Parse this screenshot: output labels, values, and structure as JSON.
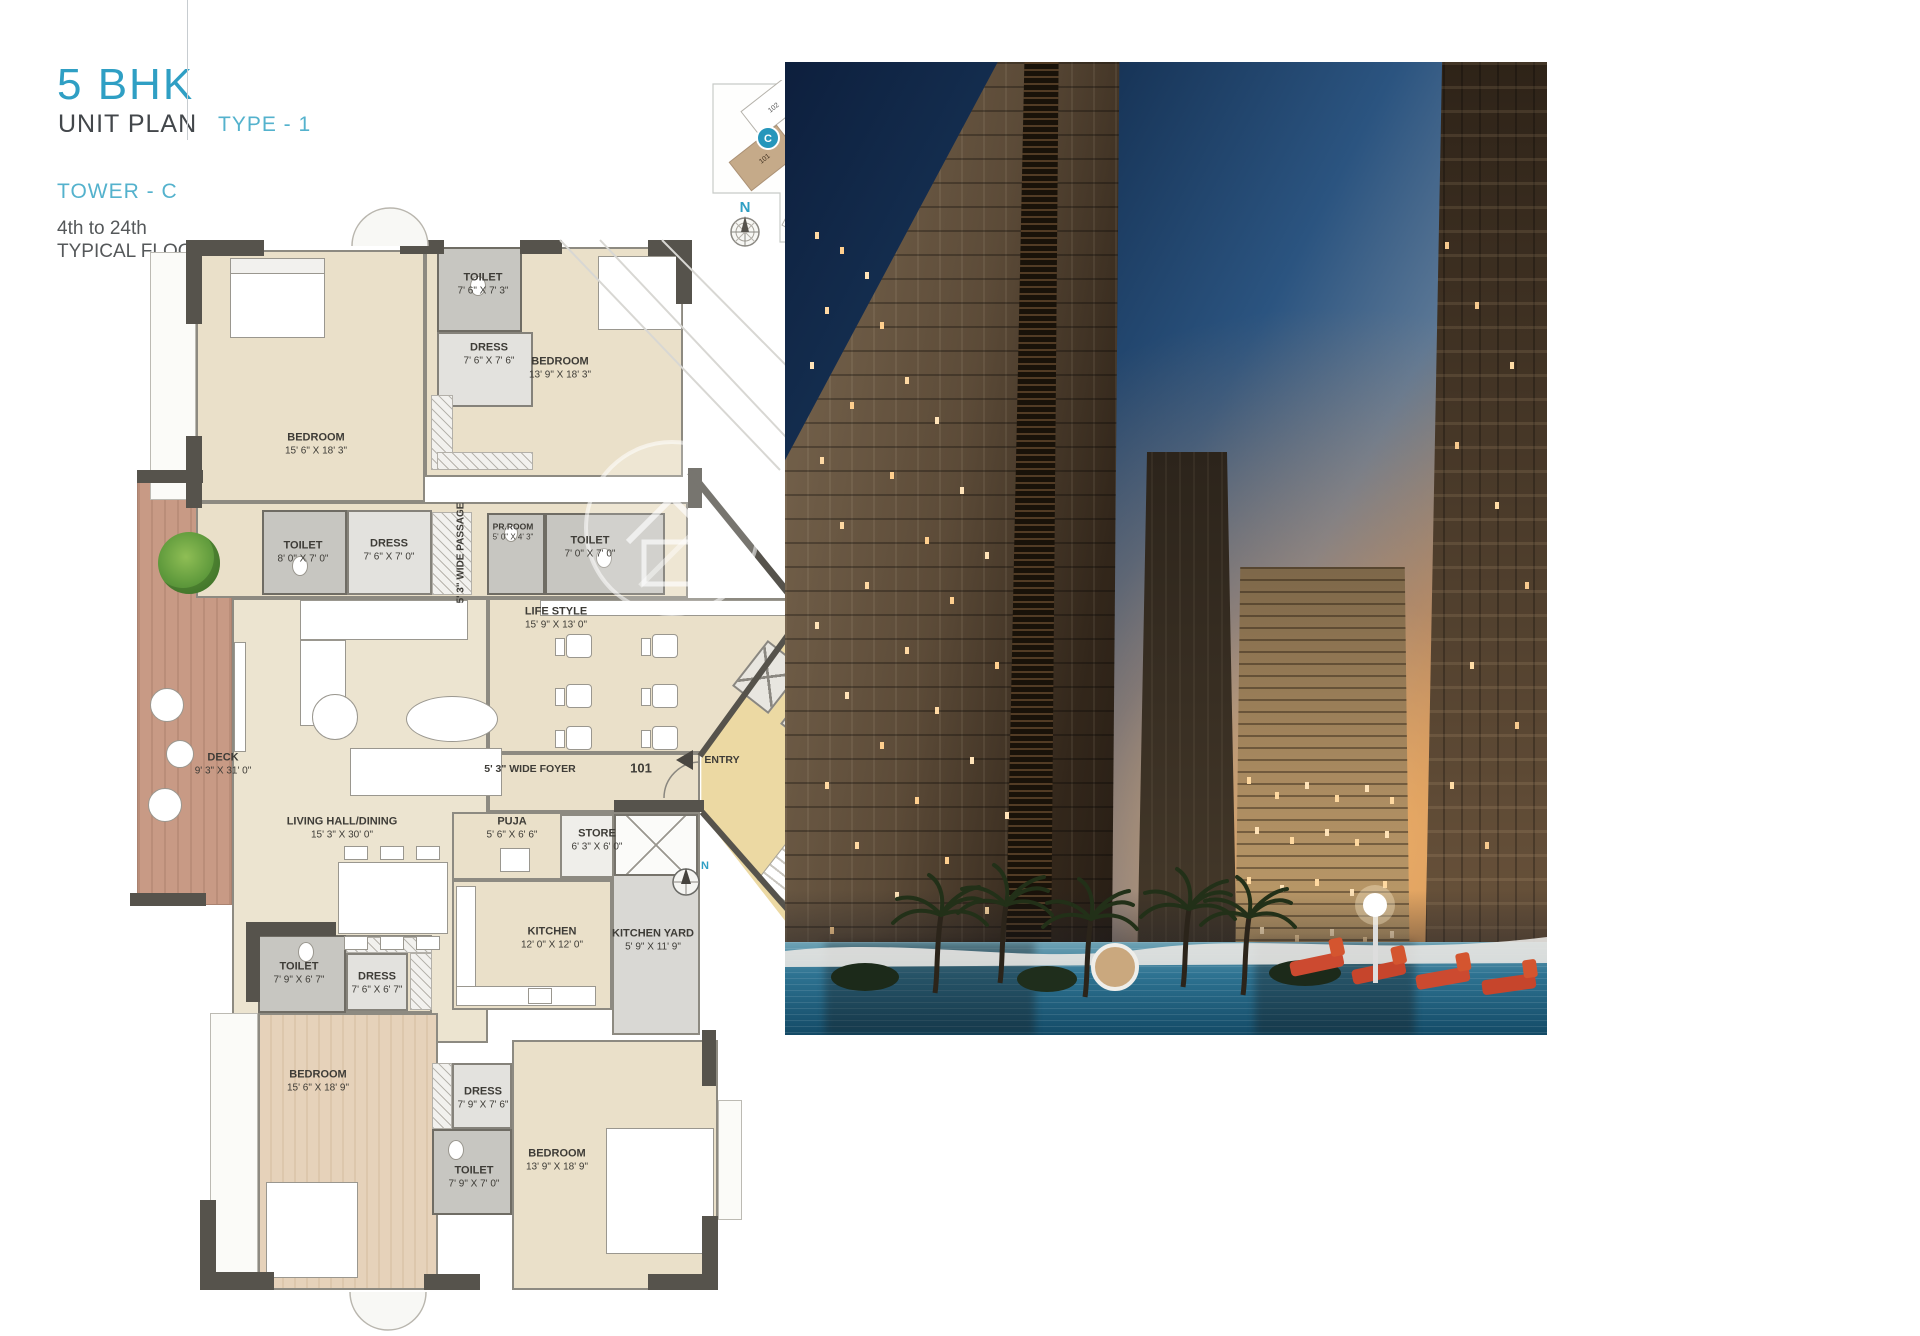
{
  "header": {
    "title": "5 BHK",
    "subtitle": "UNIT PLAN",
    "type": "TYPE - 1",
    "tower": "TOWER - C",
    "floor_line1": "4th to 24th",
    "floor_line2": "TYPICAL FLOOR"
  },
  "keyplan": {
    "badge_c": "C",
    "badge_b": "B",
    "badge_a": "A",
    "c_units": [
      "102",
      "101"
    ],
    "b_units": [
      "102",
      "101"
    ],
    "a_units": [
      "101",
      "103",
      "102"
    ],
    "compass_n": "N"
  },
  "plan": {
    "compass_n": "N",
    "unit_number": "101",
    "entry_label": "ENTRY",
    "foyer_label": "5' 3\" WIDE FOYER",
    "passage_label": "5' 3\" WIDE PASSAGE",
    "rooms": {
      "bedroom_tl": {
        "name": "BEDROOM",
        "dims": "15' 6\" X 18' 3\""
      },
      "toilet_top": {
        "name": "TOILET",
        "dims": "7' 6\" X 7' 3\""
      },
      "dress_top": {
        "name": "DRESS",
        "dims": "7' 6\" X 7' 6\""
      },
      "bedroom_tr": {
        "name": "BEDROOM",
        "dims": "13' 9\" X 18' 3\""
      },
      "toilet_ml": {
        "name": "TOILET",
        "dims": "8' 0\" X 7' 0\""
      },
      "dress_ml": {
        "name": "DRESS",
        "dims": "7' 6\" X 7' 0\""
      },
      "prroom": {
        "name": "PR.ROOM",
        "dims": "5' 0\" X 4' 3\""
      },
      "toilet_mr": {
        "name": "TOILET",
        "dims": "7' 0\" X 7' 0\""
      },
      "lifestyle": {
        "name": "LIFE STYLE",
        "dims": "15' 9\" X 13' 0\""
      },
      "deck": {
        "name": "DECK",
        "dims": "9' 3\" X 31' 0\""
      },
      "living": {
        "name": "LIVING HALL/DINING",
        "dims": "15' 3\" X 30' 0\""
      },
      "puja": {
        "name": "PUJA",
        "dims": "5' 6\" X 6' 6\""
      },
      "store": {
        "name": "STORE",
        "dims": "6' 3\" X 6' 0\""
      },
      "kitchen": {
        "name": "KITCHEN",
        "dims": "12' 0\" X 12' 0\""
      },
      "kitchen_yard": {
        "name": "KITCHEN YARD",
        "dims": "5' 9\" X 11' 9\""
      },
      "toilet_bl": {
        "name": "TOILET",
        "dims": "7' 9\" X 6' 7\""
      },
      "dress_bl": {
        "name": "DRESS",
        "dims": "7' 6\" X 6' 7\""
      },
      "bedroom_bl": {
        "name": "BEDROOM",
        "dims": "15' 6\" X 18' 9\""
      },
      "dress_bm": {
        "name": "DRESS",
        "dims": "7' 9\" X 7' 6\""
      },
      "toilet_bm": {
        "name": "TOILET",
        "dims": "7' 9\" X 7' 0\""
      },
      "bedroom_br": {
        "name": "BEDROOM",
        "dims": "13' 9\" X 18' 9\""
      }
    }
  },
  "colors": {
    "accent_teal": "#2f9fc4",
    "wall_dark": "#56534c",
    "floor_beige": "#eae0c9",
    "toilet_gray": "#c7c6c1",
    "deck_wood": "#c89a85",
    "lobby_tan": "#ecd9a3",
    "highlight_unit_tan": "#c5aa89",
    "sky_navy": "#173457",
    "sunset_orange": "#caa06a",
    "pool_blue": "#2e7392"
  }
}
